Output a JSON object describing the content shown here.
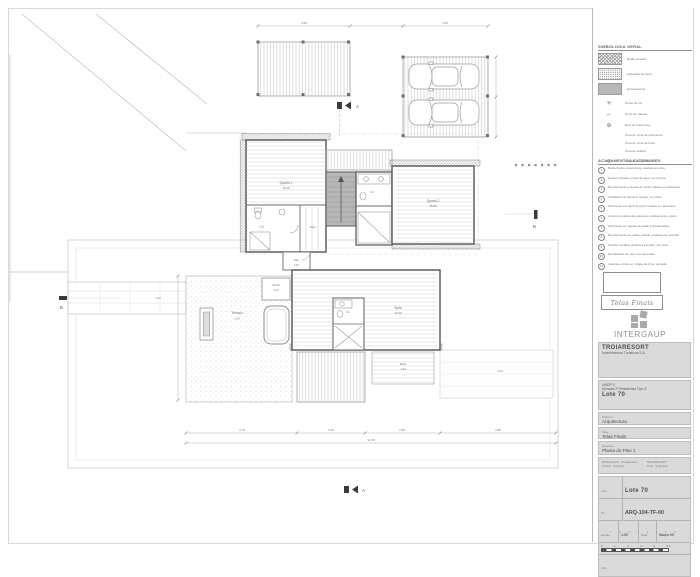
{
  "legend": {
    "title": "SIMBOLOGIA GERAL",
    "items": [
      {
        "glyph": "",
        "label": "Betão armado"
      },
      {
        "glyph": "",
        "label": "Alvenaria de tijolo"
      },
      {
        "glyph": "",
        "label": "Enrocamento"
      },
      {
        "glyph": "✳",
        "label": "Ponto de luz"
      },
      {
        "glyph": "⌐",
        "label": "Corte de parede"
      },
      {
        "glyph": "⊕",
        "label": "Eixo de referência"
      },
      {
        "glyph": "",
        "label": "Cota de nível do pavimento"
      },
      {
        "glyph": "",
        "label": "Cota de nível do tecto"
      },
      {
        "glyph": "",
        "label": "Cota de soleira"
      },
      {
        "glyph": "⬭",
        "label": "Sentido da pendente"
      }
    ]
  },
  "notes": {
    "title": "ACABAMENTOS EXTERIORES",
    "items": [
      {
        "num": "1",
        "text": "Betão branco descofrado, acabamento liso"
      },
      {
        "num": "2",
        "text": "Reboco pintado a tinta de água, cor branca"
      },
      {
        "num": "3",
        "text": "Revestimento a réguas de pinho tratado em autoclave"
      },
      {
        "num": "4",
        "text": "Caixilharia de alumínio lacado, cor cinza"
      },
      {
        "num": "5",
        "text": "Pavimento em deck de pinho tratado em autoclave"
      },
      {
        "num": "6",
        "text": "Cobertura plana não acessível, acabamento a godo"
      },
      {
        "num": "7",
        "text": "Pavimento em lajetas de betão pré-fabricadas"
      },
      {
        "num": "8",
        "text": "Revestimento em pedra natural, acabamento serrado"
      },
      {
        "num": "9",
        "text": "Guarda metálica pintada a esmalte, cor cinza"
      },
      {
        "num": "10",
        "text": "Serralharias em aço inox escovado"
      },
      {
        "num": "11",
        "text": "Caleiras e rufos em chapa de zinco quinada"
      }
    ]
  },
  "stamp": {
    "text": "Telas Finais"
  },
  "logo": {
    "name": "INTERGAUP"
  },
  "titleblock": {
    "client": "TROIARESORT",
    "client2": "Investimentos Turísticos S.A.",
    "project1": "UNOP 3",
    "project2": "Moradia 2ª Residência Tipo 3",
    "lote": "Lote 70",
    "label_projecto": "Projecto:",
    "projecto": "Arquitectura",
    "label_fase": "Fase:",
    "fase": "Telas Finais",
    "label_desenho": "Desenho:",
    "desenho": "Planta do Piso 1",
    "contacts_left": "INTERGAUP · Arquitectura",
    "contacts_left2": "Lisboa · Portugal",
    "contacts_right": "TROIARESORT",
    "contacts_right2": "Tróia · Grândola",
    "label_lote": "Lote:",
    "lote_value": "Lote 70",
    "label_num": "Nº:",
    "num_value": "ARQ-104-TF-00",
    "label_escala": "Escala",
    "escala": "1:50",
    "label_data": "Data",
    "data": "Março 09",
    "label_obs": "Obs.:",
    "scale_n0": "0",
    "scale_n1": "1",
    "scale_n2": "2",
    "scale_n3": "3",
    "scale_n4": "4",
    "scale_n5": "5 m",
    "strip": "1 2 3 4 5 6 7 8"
  },
  "plan": {
    "sections": {
      "a": "A",
      "b": "B"
    },
    "rooms": {
      "quarto1": {
        "name": "Quarto 1",
        "area": "16.45"
      },
      "quarto2": {
        "name": "Quarto 2",
        "area": "15.80"
      },
      "is1": {
        "name": "I.S."
      },
      "is2": {
        "name": "I.S."
      },
      "vest": {
        "name": "Vest."
      },
      "hall": {
        "name": "Hall",
        "level": "1.24"
      },
      "suite": {
        "name": "Suite",
        "area": "22.30"
      },
      "is3": {
        "name": "I.S."
      },
      "terraco": {
        "name": "Terraço",
        "level": "1.24"
      },
      "apoio": {
        "name": "Apoio",
        "level": "1.24"
      },
      "deck": {
        "name": "Deck",
        "level": "1.24"
      }
    },
    "levels": {
      "l1": "1.24",
      "l2": "1.24"
    },
    "dims": {
      "d1": "3.70",
      "d2": "2.25",
      "d3": "2.50",
      "d4": "3.85",
      "total": "12.30",
      "t1": "4.60",
      "t2": "4.25"
    }
  }
}
